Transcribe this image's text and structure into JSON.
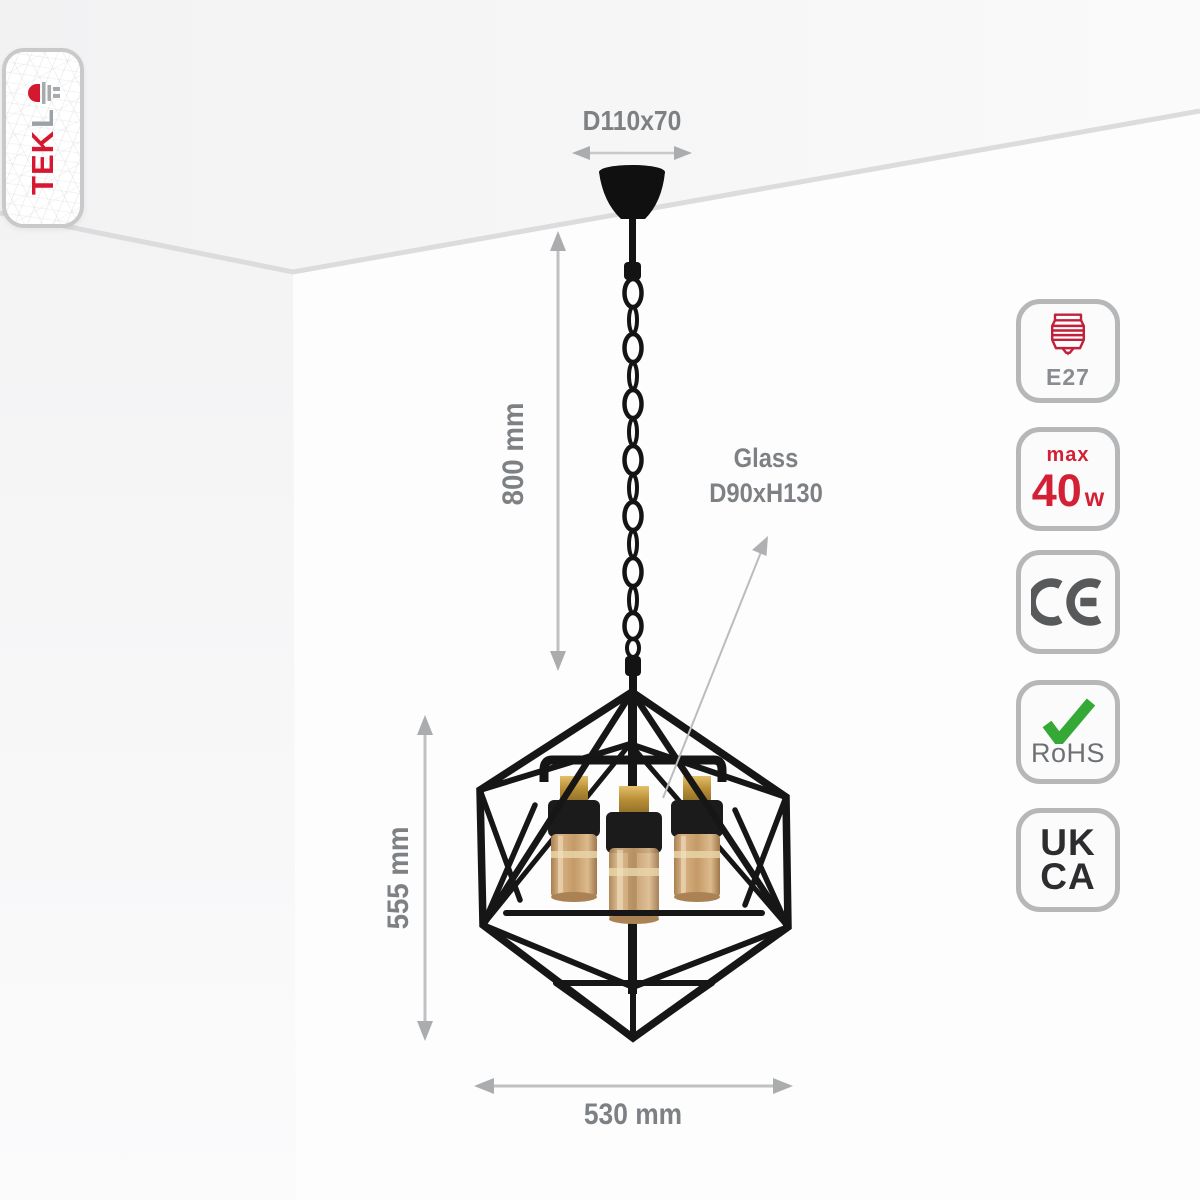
{
  "brand": {
    "name_red_part": "TEK",
    "name_grey_part": "L",
    "led_icon": "led-diode-icon"
  },
  "dimensions": {
    "canopy": "D110x70",
    "drop_height": "800 mm",
    "fixture_height": "555 mm",
    "fixture_width": "530 mm",
    "glass_label_line1": "Glass",
    "glass_label_line2": "D90xH130"
  },
  "badges": [
    {
      "id": "e27-socket",
      "icon": "e27-bulb-base-icon",
      "label": "E27"
    },
    {
      "id": "max-wattage",
      "prefix": "max",
      "value": "40",
      "unit": "w"
    },
    {
      "id": "ce-mark",
      "label": "CE",
      "icon": "ce-mark-icon"
    },
    {
      "id": "rohs",
      "icon": "green-checkmark-icon",
      "label": "RoHS"
    },
    {
      "id": "ukca",
      "line1": "UK",
      "line2": "CA"
    }
  ],
  "colors": {
    "brand_red": "#d5182f",
    "badge_red": "#d32035",
    "rohs_green": "#35a936",
    "frame_black": "#161616",
    "dimension_grey": "#7e8184",
    "arrow_grey": "#aaacae",
    "glass_amber": "#c69f6e",
    "brass": "#c2983f"
  }
}
